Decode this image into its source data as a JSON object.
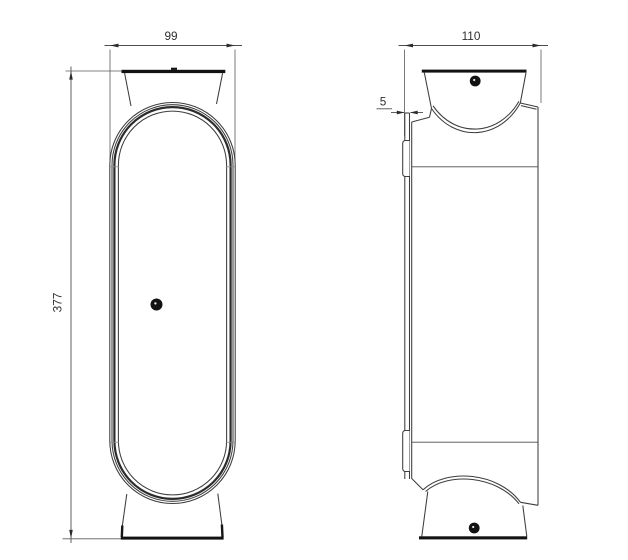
{
  "dimensions": {
    "front_width": "99",
    "front_height": "377",
    "side_depth": "110",
    "wall_plate_thickness": "5"
  },
  "icons": {
    "screw": "screw-head-dot"
  },
  "colors": {
    "background": "#ffffff",
    "outline": "#3d3d3d",
    "solid_edge": "#121212",
    "dimension_line": "#4f4f4f",
    "text": "#2e2e2e"
  }
}
